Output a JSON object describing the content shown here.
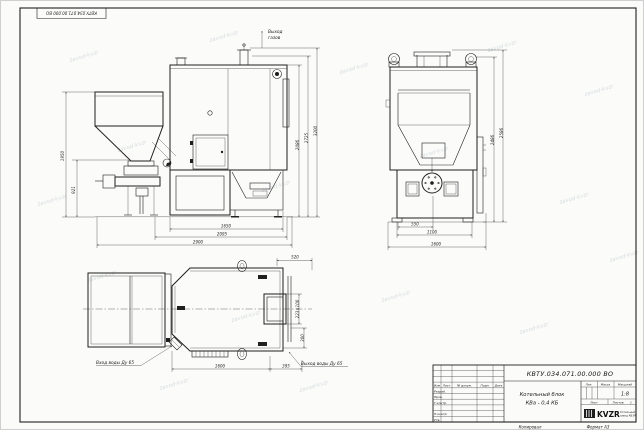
{
  "sheet": {
    "stamp_top": "КВТУ.034.071.00.000 ВО",
    "watermark": "zavod-kvzr",
    "footer": {
      "copied": "Копировал",
      "format": "Формат А3"
    }
  },
  "side_view": {
    "gas_outlet_line1": "Выход",
    "gas_outlet_line2": "газов",
    "dim_hopper_height": "1950",
    "dim_feeder_height": "921",
    "dim_body_height": "2086",
    "dim_mid_height": "2725",
    "dim_total_height": "3200",
    "dim_base_width": "1650",
    "dim_mid_width": "2095",
    "dim_total_width": "2900"
  },
  "front_view": {
    "dim_inner_width": "550",
    "dim_body_width": "1100",
    "dim_total_width": "1600",
    "dim_body_height": "2486",
    "dim_total_height": "2586"
  },
  "plan_view": {
    "water_inlet": "Вход воды Ду 65",
    "water_outlet": "Выход воды Ду 65",
    "dim_outlet_offset": "520",
    "dim_outlet_size": "223×100",
    "dim_rear_offset": "300",
    "dim_body_length": "1600",
    "dim_rear_length": "395"
  },
  "title_block": {
    "doc_number": "КВТУ.034.071.00.000 ВО",
    "title_line1": "Котельный блок",
    "title_line2": "КВа - 0,4 КБ",
    "cols": {
      "izm": "Изм",
      "list": "Лист",
      "doc": "№ докум.",
      "sign": "Подп.",
      "date": "Дата"
    },
    "rows": {
      "razrab": "Разраб.",
      "prov": "Пров.",
      "tkontr": "Т.контр.",
      "nkontr": "Н.контр.",
      "utv": "Утв."
    },
    "lit_label": "Лит.",
    "mass_label": "Масса",
    "scale_label": "Масштаб",
    "scale_value": "1:8",
    "sheet_label": "Лист",
    "sheets_label": "Листов",
    "sheets_value": "1",
    "brand": "KVZR",
    "brand_line1": "Котельный",
    "brand_line2": "завод КВЗР"
  }
}
